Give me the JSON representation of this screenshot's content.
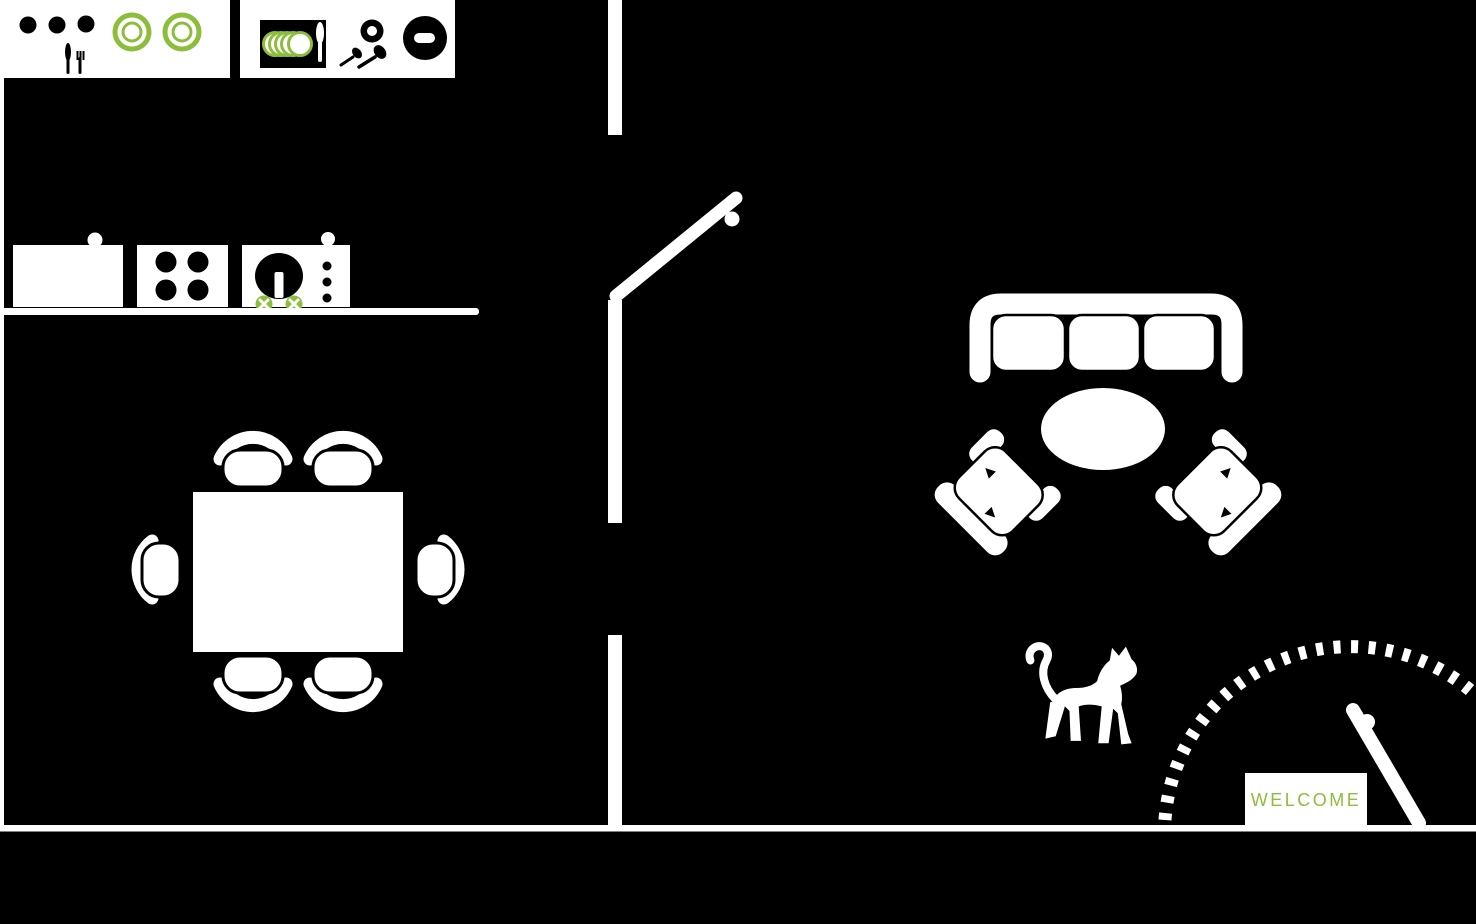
{
  "title": "Apartment floor plan",
  "colors": {
    "background": "#000000",
    "walls_and_furniture": "#ffffff",
    "accent_green": "#8CBE3C"
  },
  "entry": {
    "mat_text": "WELCOME",
    "items": [
      "entry-door",
      "door-swing-arc",
      "welcome-mat"
    ]
  },
  "kitchen": {
    "items": [
      "upper-counter-dishes",
      "upper-counter-tray",
      "fridge",
      "cooktop-4-burners",
      "sink",
      "kitchen-counter",
      "dining-table",
      "dining-chairs-x6"
    ]
  },
  "living_room": {
    "items": [
      "sofa-3-seat",
      "oval-coffee-table",
      "armchair-left",
      "armchair-right",
      "cat"
    ]
  },
  "walls": {
    "items": [
      "left-wall",
      "bottom-wall",
      "center-wall-upper",
      "center-wall-middle",
      "center-wall-lower",
      "interior-door"
    ]
  }
}
